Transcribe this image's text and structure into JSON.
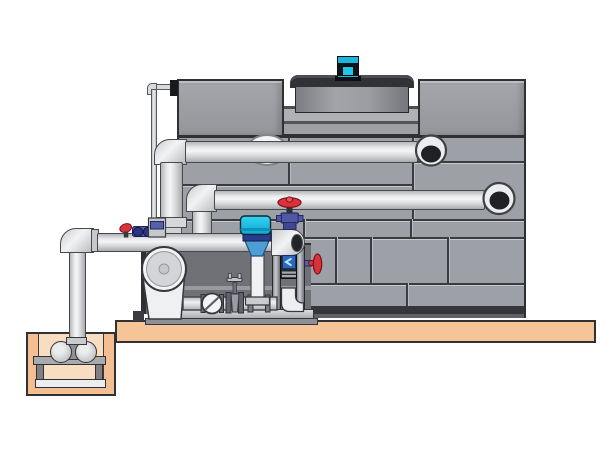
{
  "diagram": {
    "type": "technical-illustration",
    "subject": "Cooling tower with pump skid, chemical feeder, sump pit and piping",
    "text_labels": [],
    "components": [
      {
        "name": "fan-motor",
        "color": "#17b7de"
      },
      {
        "name": "fan-shroud",
        "color": "#84868c"
      },
      {
        "name": "tower-upper-left-cell",
        "color": "#9a9ca2"
      },
      {
        "name": "tower-upper-right-cell",
        "color": "#9a9ca2"
      },
      {
        "name": "tower-wall-panels",
        "color": "#9da0a6"
      },
      {
        "name": "riser-pipe",
        "color": "#ecedef"
      },
      {
        "name": "upper-distribution-pipe",
        "color": "#ecedef"
      },
      {
        "name": "lower-distribution-pipe",
        "color": "#ecedef"
      },
      {
        "name": "main-suction-pipe",
        "color": "#ecedef"
      },
      {
        "name": "make-up-line",
        "color": "#d8dadc"
      },
      {
        "name": "centrifugal-pump",
        "color": "#eff0f2"
      },
      {
        "name": "check-valve",
        "color": "#f2f3f4"
      },
      {
        "name": "gate-valve",
        "color": "#9a9ca2"
      },
      {
        "name": "chemical-feeder-funnel",
        "color": "#4e9ed6"
      },
      {
        "name": "feeder-cap",
        "color": "#1fc6ec"
      },
      {
        "name": "globe-valve",
        "color": "#d8333c"
      },
      {
        "name": "butterfly-valve",
        "color": "#d8333c"
      },
      {
        "name": "dosing-valve-cluster",
        "color": "#4f59a8"
      },
      {
        "name": "equipment-frame",
        "color": "#26282c"
      },
      {
        "name": "skid-base-rails",
        "color": "#c7c9cd"
      },
      {
        "name": "concrete-slab",
        "color": "#f5c497"
      },
      {
        "name": "sump-pit",
        "color": "#f2be92"
      },
      {
        "name": "sump-pump",
        "color": "#c9cbce"
      }
    ],
    "palette": {
      "background": "#ffffff",
      "panel_gray": "#9da0a6",
      "seam_dark": "#3a3c40",
      "pipe_light": "#ecedef",
      "outline": "#2e3033",
      "accent_cyan": "#17b7de",
      "accent_red": "#d8333c",
      "accent_blue": "#4f59a8",
      "concrete_tan": "#f5c497"
    }
  }
}
